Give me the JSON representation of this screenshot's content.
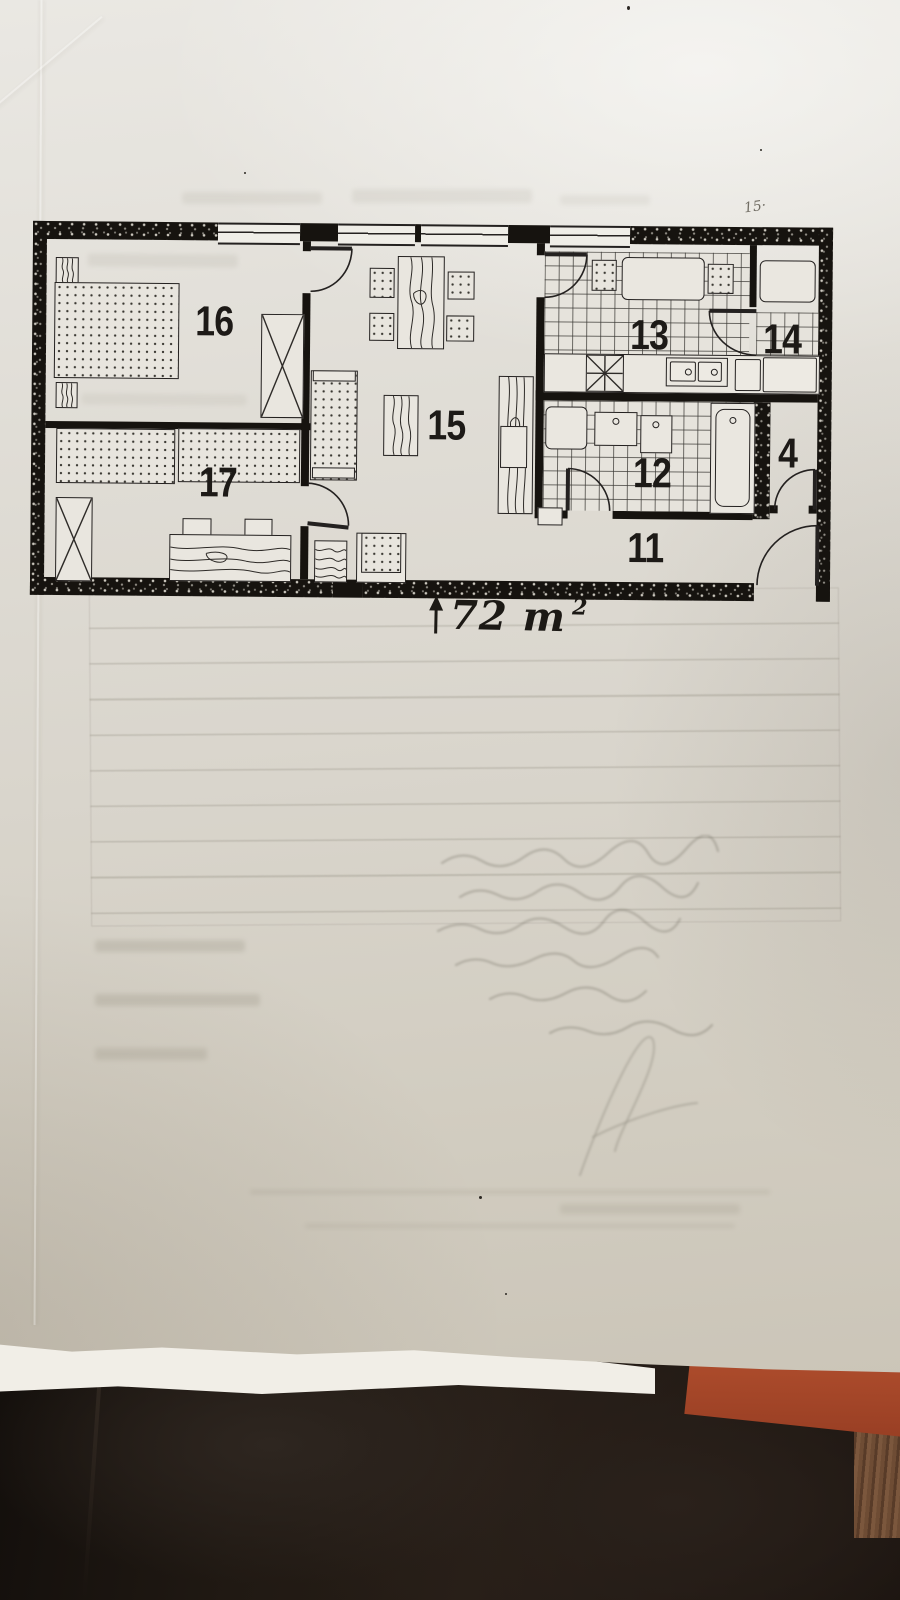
{
  "floor_plan": {
    "rooms": [
      {
        "number": "16",
        "furniture": [
          "double-bed",
          "nightstand",
          "nightstand",
          "wardrobe"
        ]
      },
      {
        "number": "17",
        "furniture": [
          "bed",
          "bed",
          "wardrobe",
          "desk",
          "chair",
          "chair"
        ]
      },
      {
        "number": "15",
        "furniture": [
          "dining-table",
          "chair",
          "chair",
          "chair",
          "chair",
          "sofa",
          "coffee-table",
          "cabinet",
          "armchair",
          "magazine-rack"
        ]
      },
      {
        "number": "13",
        "furniture": [
          "kitchen-table",
          "stool",
          "stool",
          "stove",
          "double-sink",
          "counter"
        ]
      },
      {
        "number": "14",
        "furniture": [
          "counter",
          "worktop"
        ]
      },
      {
        "number": "12",
        "furniture": [
          "toilet",
          "washbasin",
          "washbasin",
          "bathtub"
        ]
      },
      {
        "number": "4",
        "furniture": []
      },
      {
        "number": "11",
        "furniture": []
      }
    ],
    "area_annotation": {
      "arrow_icon": "up-arrow",
      "text": "72 m",
      "superscript": "2"
    },
    "pencil_note": "15·"
  },
  "photo": {
    "paper_color": "#dcd8d0",
    "ink_color": "#242120",
    "wall_color": "#16130f",
    "background_fabric_color": "#1d1712",
    "red_folder_color": "#b04e2e",
    "wood_color": "#6e4c34"
  }
}
